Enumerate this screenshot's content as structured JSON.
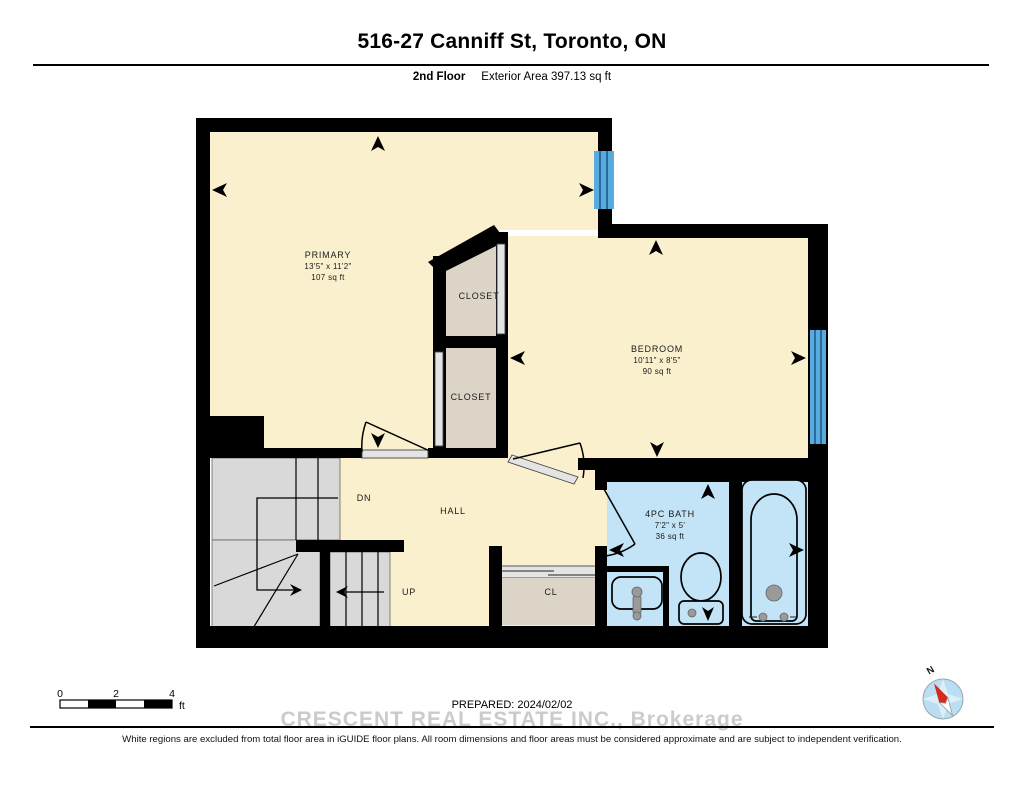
{
  "header": {
    "title": "516-27 Canniff St, Toronto, ON",
    "floor_label": "2nd Floor",
    "area_label": "Exterior Area 397.13 sq ft"
  },
  "floorplan": {
    "rooms": {
      "primary": {
        "name": "PRIMARY",
        "dims": "13'5\" x 11'2\"",
        "area": "107 sq ft"
      },
      "closet_upper": {
        "name": "CLOSET"
      },
      "closet_lower": {
        "name": "CLOSET"
      },
      "bedroom": {
        "name": "BEDROOM",
        "dims": "10'11\" x 8'5\"",
        "area": "90 sq ft"
      },
      "bath": {
        "name": "4PC BATH",
        "dims": "7'2\" x 5'",
        "area": "36 sq ft"
      },
      "hall": {
        "name": "HALL"
      },
      "stairs_down_label": "DN",
      "stairs_up_label": "UP",
      "closet_small_label": "CL"
    }
  },
  "scale_bar": {
    "ticks": [
      "0",
      "2",
      "4"
    ],
    "unit": "ft"
  },
  "compass": {
    "north_label": "N"
  },
  "footer": {
    "prepared": "PREPARED: 2024/02/02",
    "watermark": "CRESCENT REAL ESTATE INC., Brokerage",
    "disclaimer": "White regions are excluded from total floor area in iGUIDE floor plans. All room dimensions and floor areas must be considered approximate and are subject to independent verification."
  },
  "colors": {
    "room_fill": "#faf0cd",
    "closet_fill": "#dcd4c6",
    "stairs_fill": "#d9d9d9",
    "bath_fill": "#c3e3f6",
    "window_fill": "#5aabdd",
    "wall": "#000000",
    "watermark_gray": "#cbcbcb"
  }
}
